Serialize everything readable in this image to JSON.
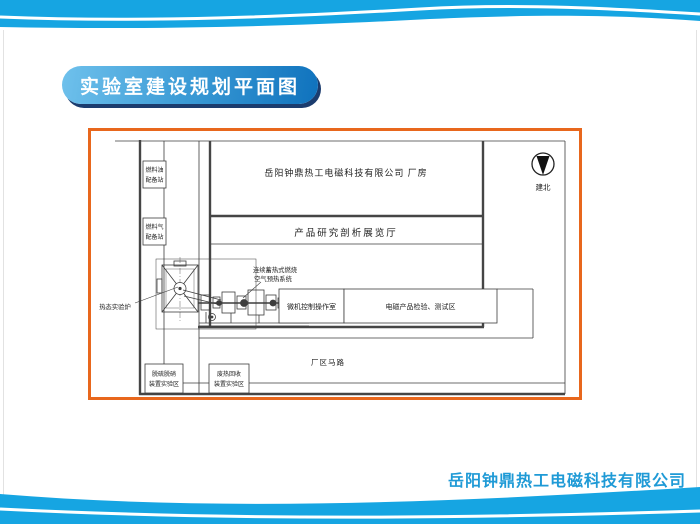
{
  "title": {
    "text": "实验室建设规划平面图"
  },
  "footer": {
    "company": "岳阳钟鼎热工电磁科技有限公司"
  },
  "colors": {
    "wave_blue": "#16a5e2",
    "title_gradient_start": "#6fc1ec",
    "title_gradient_end": "#0f72bd",
    "title_shadow": "#1b3c6e",
    "plan_border": "#e8671d",
    "footer_text": "#1f9ad6",
    "cad_line": "#3d3d3d"
  },
  "plan": {
    "factory_building": "岳阳钟鼎热工电磁科技有限公司  厂房",
    "exhibition_hall": "产品研究剖析展览厅",
    "fuel_oil_station": {
      "line1": "燃料油",
      "line2": "配备站"
    },
    "fuel_gas_station": {
      "line1": "燃料气",
      "line2": "配备站"
    },
    "preheat_system": {
      "line1": "连续蓄热式燃烧",
      "line2": "空气预热系统"
    },
    "hot_test_furnace": "热态实验炉",
    "control_room": "微机控制操作室",
    "test_area": "电磁产品检验、测试区",
    "road": "厂区马路",
    "desulfurization_area": {
      "line1": "脱硫脱硝",
      "line2": "装置实验区"
    },
    "waste_heat_area": {
      "line1": "废热回收",
      "line2": "装置实验区"
    },
    "north_arrow_label": "建北"
  }
}
